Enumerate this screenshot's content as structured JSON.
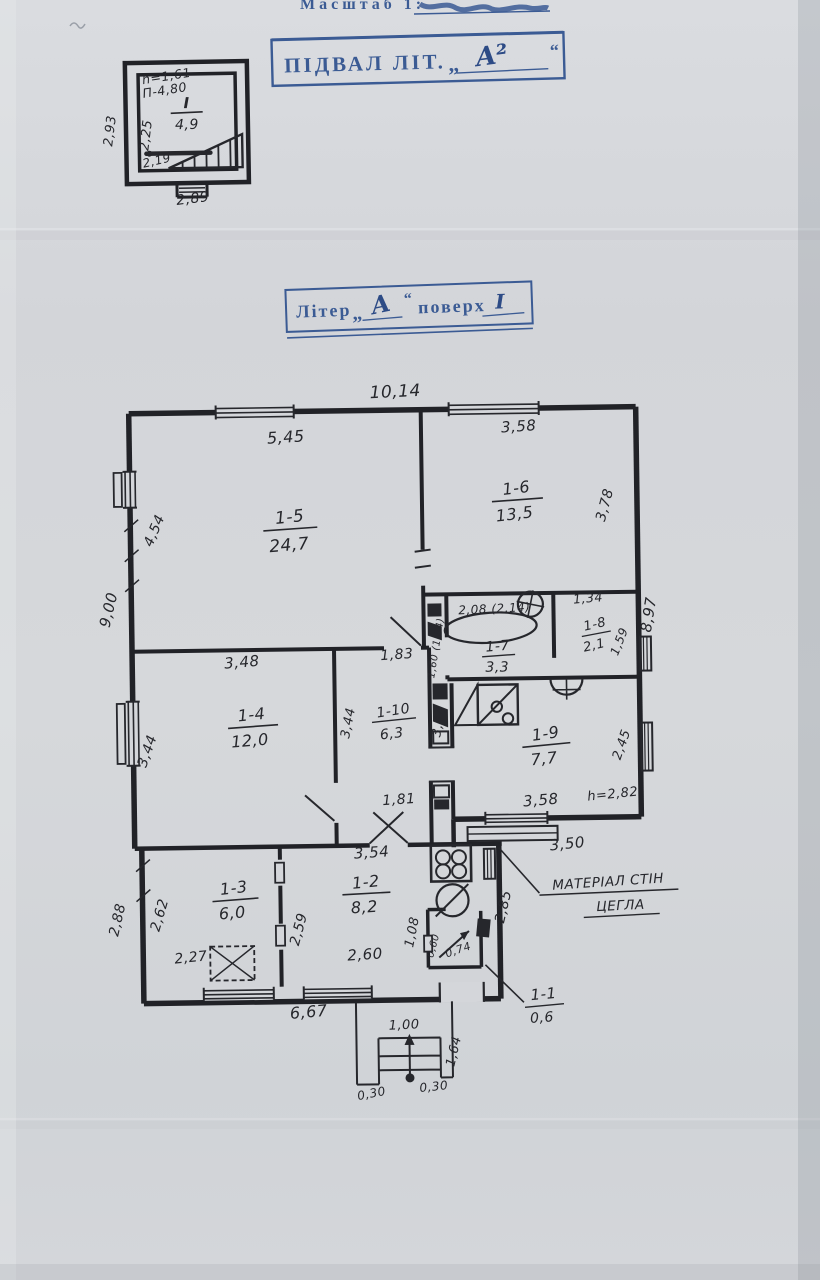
{
  "header": {
    "scale_label": "Масштаб 1:"
  },
  "basement": {
    "stamp_label": "ПІДВАЛ ЛІТ.",
    "stamp_quote_open": "„",
    "stamp_value": "А²",
    "stamp_quote_close": "“",
    "room_no": "І",
    "room_area": "4,9",
    "note_h": "h=1,61",
    "note_p": "П-4,80",
    "dim_left_outer": "2,93",
    "dim_left_inner": "2,25",
    "dim_bottom_inner": "2,19",
    "dim_bottom_outer": "2,89"
  },
  "floor_stamp": {
    "label": "Літер",
    "quote_open": "„",
    "letter": "А",
    "quote_close": "“",
    "middle": "поверх",
    "floor_no": "І"
  },
  "plan": {
    "dims": {
      "top": "10,14",
      "left": "9,00",
      "right": "8,97",
      "bottom_annex": "6,67",
      "bottom_right": "3,50",
      "bottom_mid": "3,54",
      "annex_left_outer": "2,88"
    },
    "rooms": {
      "r1": {
        "no": "1-1",
        "area": "0,6",
        "w": "0,60",
        "h": "1,08",
        "d": "0,74"
      },
      "r2": {
        "no": "1-2",
        "area": "8,2",
        "left": "2,59",
        "bottom": "2,60",
        "right": "2,85"
      },
      "r3": {
        "no": "1-3",
        "area": "6,0",
        "left": "2,62",
        "bottom": "2,27"
      },
      "r4": {
        "no": "1-4",
        "area": "12,0",
        "top": "3,48",
        "left": "3,44"
      },
      "r5": {
        "no": "1-5",
        "area": "24,7",
        "top": "5,45",
        "left": "4,54"
      },
      "r6": {
        "no": "1-6",
        "area": "13,5",
        "top": "3,58",
        "right": "3,78"
      },
      "r7": {
        "no": "1-7",
        "area": "3,3",
        "top": "2,08 (2,14)",
        "left": "1,60 (1,64)"
      },
      "r8": {
        "no": "1-8",
        "area": "2,1",
        "top": "1,34",
        "right": "1,59"
      },
      "r9": {
        "no": "1-9",
        "area": "7,7",
        "bottom": "3,58",
        "right": "2,45",
        "height": "h=2,82"
      },
      "r10": {
        "no": "1-10",
        "area": "6,3",
        "top": "1,83",
        "left": "3,44",
        "right": "3,44",
        "bottom": "1,81"
      }
    },
    "note_line1": "МАТЕРІАЛ СТІН",
    "note_line2": "ЦЕГЛА",
    "porch": {
      "width": "1,00",
      "depth": "1,64",
      "step_left": "0,30",
      "step_right": "0,30"
    }
  }
}
